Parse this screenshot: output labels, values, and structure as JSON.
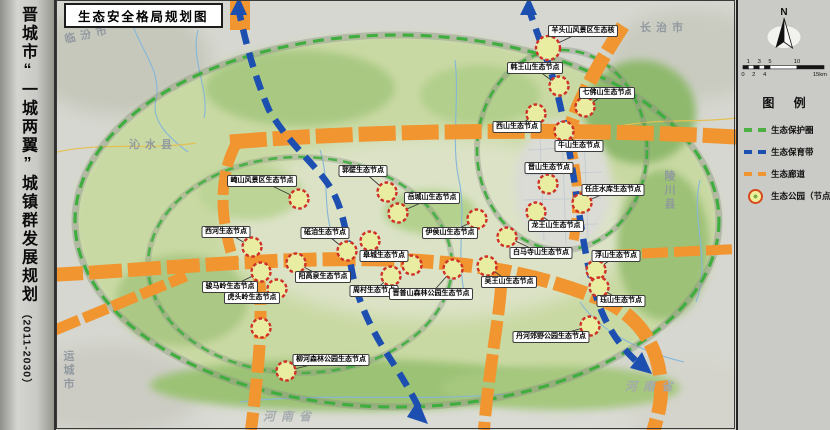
{
  "sidebar": {
    "title": "晋城市“一城两翼”城镇群发展规划",
    "subtitle": "（2011-2030）"
  },
  "map": {
    "title": "生态安全格局规划图",
    "region_labels": [
      {
        "text": "临汾市",
        "x": 88,
        "y": 34,
        "rotate": -12
      },
      {
        "text": "长治市",
        "x": 664,
        "y": 27
      },
      {
        "text": "沁水县",
        "x": 153,
        "y": 144
      },
      {
        "text": "陵川县",
        "x": 669,
        "y": 191,
        "vertical": true
      },
      {
        "text": "运城市",
        "x": 68,
        "y": 371,
        "vertical": true
      },
      {
        "text": "河南省",
        "x": 290,
        "y": 416,
        "italic": true
      },
      {
        "text": "河南省",
        "x": 652,
        "y": 386,
        "italic": true
      }
    ],
    "nodes": [
      {
        "label": "羊头山风景区生态核",
        "lx": 583,
        "ly": 31,
        "cx": 548,
        "cy": 48,
        "r": 12
      },
      {
        "label": "韩王山生态节点",
        "lx": 535,
        "ly": 68,
        "cx": 559,
        "cy": 86
      },
      {
        "label": "七佛山生态节点",
        "lx": 607,
        "ly": 93,
        "cx": 585,
        "cy": 107
      },
      {
        "label": "西山生态节点",
        "lx": 517,
        "ly": 127,
        "cx": 536,
        "cy": 114
      },
      {
        "label": "牛山生态节点",
        "lx": 579,
        "ly": 146,
        "cx": 564,
        "cy": 131
      },
      {
        "label": "晋山生态节点",
        "lx": 549,
        "ly": 168,
        "cx": 548,
        "cy": 184
      },
      {
        "label": "任庄水库生态节点",
        "lx": 613,
        "ly": 190,
        "cx": 582,
        "cy": 203
      },
      {
        "label": "崦山风景区生态节点",
        "lx": 262,
        "ly": 181,
        "cx": 299,
        "cy": 199
      },
      {
        "label": "郭壁生态节点",
        "lx": 363,
        "ly": 171,
        "cx": 387,
        "cy": 192
      },
      {
        "label": "岳城山生态节点",
        "lx": 432,
        "ly": 198,
        "cx": 398,
        "cy": 213
      },
      {
        "label": "伊侯山生态节点",
        "lx": 450,
        "ly": 233,
        "cx": 477,
        "cy": 219
      },
      {
        "label": "西河生态节点",
        "lx": 226,
        "ly": 232,
        "cx": 252,
        "cy": 247
      },
      {
        "label": "砥洎生态节点",
        "lx": 325,
        "ly": 233,
        "cx": 347,
        "cy": 251
      },
      {
        "label": "龙王山生态节点",
        "lx": 556,
        "ly": 226,
        "cx": 536,
        "cy": 212
      },
      {
        "label": "白马寺山生态节点",
        "lx": 541,
        "ly": 253,
        "cx": 507,
        "cy": 237
      },
      {
        "label": "浮山生态节点",
        "lx": 616,
        "ly": 256,
        "cx": 596,
        "cy": 270
      },
      {
        "label": "皋城生态节点",
        "lx": 384,
        "ly": 256,
        "cx": 370,
        "cy": 241
      },
      {
        "label": "吴王山生态节点",
        "lx": 509,
        "ly": 282,
        "cx": 487,
        "cy": 266
      },
      {
        "label": "阳高泉生态节点",
        "lx": 323,
        "ly": 277,
        "cx": 296,
        "cy": 263
      },
      {
        "label": "骏马岭生态节点",
        "lx": 230,
        "ly": 287,
        "cx": 261,
        "cy": 272
      },
      {
        "label": "周村生态节点",
        "lx": 374,
        "ly": 291,
        "cx": 391,
        "cy": 276
      },
      {
        "label": "晋普山森林公园生态节点",
        "lx": 431,
        "ly": 294,
        "cx": 453,
        "cy": 269
      },
      {
        "label": "虎头岭生态节点",
        "lx": 252,
        "ly": 298,
        "cx": 277,
        "cy": 289
      },
      {
        "label": "珏山生态节点",
        "lx": 621,
        "ly": 301,
        "cx": 599,
        "cy": 287
      },
      {
        "label": "丹河郊野公园生态节点",
        "lx": 551,
        "ly": 337,
        "cx": 590,
        "cy": 326
      },
      {
        "label": "柳河森林公园生态节点",
        "lx": 331,
        "ly": 360,
        "cx": 286,
        "cy": 371
      },
      {
        "label": "",
        "cx": 261,
        "cy": 328
      },
      {
        "label": "",
        "cx": 412,
        "cy": 265
      }
    ]
  },
  "legend": {
    "north_label": "N",
    "title": "图 例",
    "items": [
      {
        "type": "protect",
        "label": "生态保护圈"
      },
      {
        "type": "conserve",
        "label": "生态保育带"
      },
      {
        "type": "corridor",
        "label": "生态廊道"
      },
      {
        "type": "park",
        "label": "生态公园（节点）"
      }
    ],
    "scale": {
      "top_ticks": [
        {
          "km": 1,
          "t": "1"
        },
        {
          "km": 3,
          "t": "3"
        },
        {
          "km": 5,
          "t": "5"
        },
        {
          "km": 10,
          "t": "10"
        }
      ],
      "bottom_ticks": [
        {
          "km": 0,
          "t": "0"
        },
        {
          "km": 2,
          "t": "2"
        },
        {
          "km": 4,
          "t": "4"
        }
      ],
      "end_label": "15km",
      "km_edges": [
        0,
        1,
        2,
        3,
        4,
        5,
        10,
        15
      ]
    }
  },
  "colors": {
    "corridor_orange": "#f0952f",
    "conservation_blue": "#1c4fb0",
    "protection_green": "#3fae3f",
    "node_fill": "#e9eda1",
    "node_ring": "#cf3128",
    "region_green": "#c9d9a3",
    "terrain_gray": "#d6d7d0"
  }
}
